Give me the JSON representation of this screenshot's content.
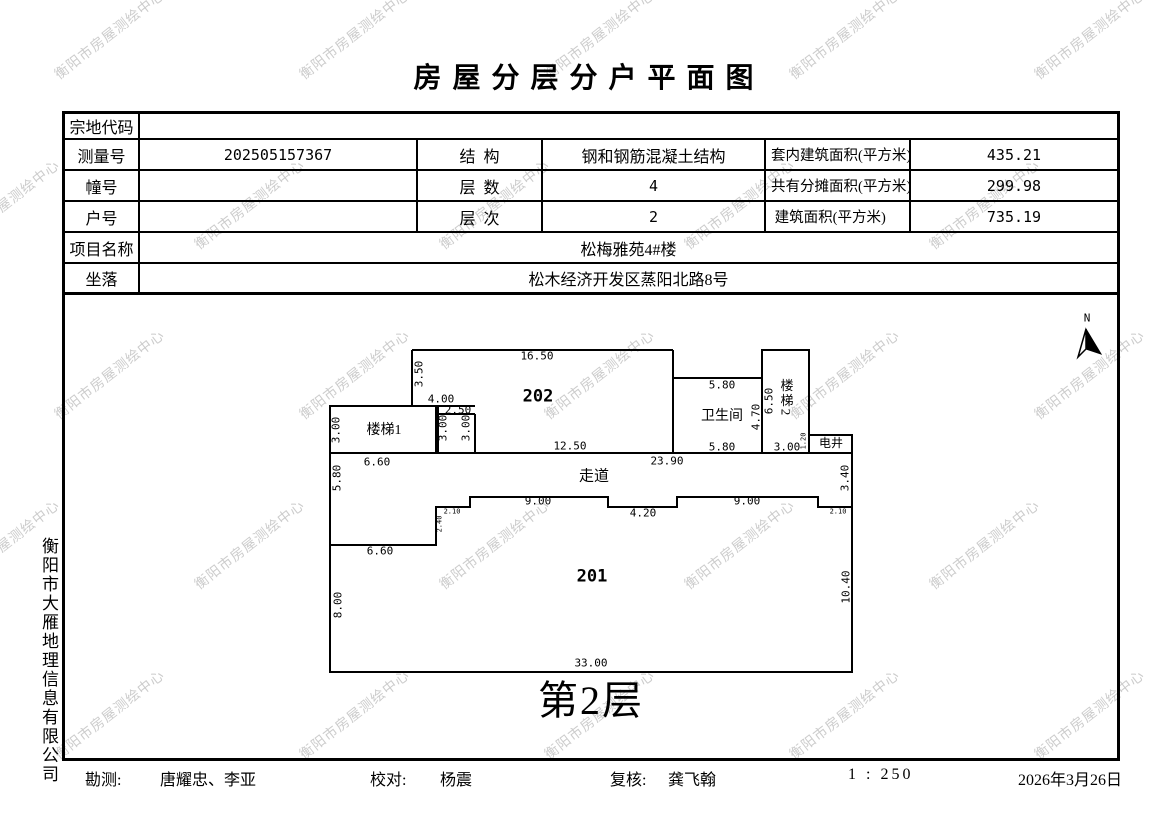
{
  "title": "房 屋 分 层 分 户 平 面 图",
  "watermark": {
    "text": "衡阳市房屋测绘中心",
    "color": "#c7c7c7"
  },
  "side_label": "衡阳市大雁地理信息有限公司",
  "table": {
    "parcel_label": "宗地代码",
    "parcel_value": "",
    "survey_label": "测量号",
    "survey_value": "202505157367",
    "structure_label": "结  构",
    "structure_value": "钢和钢筋混凝土结构",
    "inner_area_label": "套内建筑面积(平方米)",
    "inner_area_value": "435.21",
    "building_no_label": "幢号",
    "building_no_value": "",
    "floors_label": "层  数",
    "floors_value": "4",
    "shared_area_label": "共有分摊面积(平方米)",
    "shared_area_value": "299.98",
    "unit_no_label": "户号",
    "unit_no_value": "",
    "level_label": "层  次",
    "level_value": "2",
    "total_area_label": " 建筑面积(平方米)",
    "total_area_value": "735.19",
    "project_label": "项目名称",
    "project_value": "松梅雅苑4#楼",
    "location_label": "坐落",
    "location_value": "松木经济开发区蒸阳北路8号"
  },
  "plan": {
    "floor_caption": "第2层",
    "north_label": "N",
    "rooms": [
      {
        "t": "202",
        "x": 538,
        "y": 397,
        "cls": "room"
      },
      {
        "t": "201",
        "x": 592,
        "y": 577,
        "cls": "room"
      },
      {
        "t": "卫生间",
        "x": 722,
        "y": 417,
        "cls": "zh"
      },
      {
        "t": "走道",
        "x": 594,
        "y": 477,
        "cls": "zh-b"
      },
      {
        "t": "楼梯1",
        "x": 384,
        "y": 431,
        "cls": "zh"
      },
      {
        "t": "楼梯2",
        "x": 786,
        "y": 398,
        "cls": "zh-v"
      },
      {
        "t": "电井",
        "x": 831,
        "y": 443,
        "cls": "zh-s"
      }
    ],
    "dims": [
      {
        "t": "16.50",
        "x": 537,
        "y": 356
      },
      {
        "t": "3.50",
        "x": 419,
        "y": 374,
        "r": 1
      },
      {
        "t": "4.00",
        "x": 441,
        "y": 399
      },
      {
        "t": "2.50",
        "x": 458,
        "y": 410
      },
      {
        "t": "3.00",
        "x": 443,
        "y": 428,
        "r": 1
      },
      {
        "t": "3.00",
        "x": 466,
        "y": 428,
        "r": 1
      },
      {
        "t": "3.00",
        "x": 336,
        "y": 430,
        "r": 1
      },
      {
        "t": "6.60",
        "x": 377,
        "y": 462
      },
      {
        "t": "12.50",
        "x": 570,
        "y": 446
      },
      {
        "t": "5.80",
        "x": 722,
        "y": 385
      },
      {
        "t": "5.80",
        "x": 722,
        "y": 447
      },
      {
        "t": "6.50",
        "x": 769,
        "y": 401,
        "r": 1
      },
      {
        "t": "4.70",
        "x": 756,
        "y": 417,
        "r": 1
      },
      {
        "t": "3.00",
        "x": 787,
        "y": 447
      },
      {
        "t": "1.20",
        "x": 804,
        "y": 441,
        "r": 1,
        "s": 1
      },
      {
        "t": "23.90",
        "x": 667,
        "y": 461
      },
      {
        "t": "5.80",
        "x": 337,
        "y": 478,
        "r": 1
      },
      {
        "t": "3.40",
        "x": 845,
        "y": 478,
        "r": 1
      },
      {
        "t": "2.10",
        "x": 452,
        "y": 512,
        "s": 1
      },
      {
        "t": "2.40",
        "x": 440,
        "y": 524,
        "r": 1,
        "s": 1
      },
      {
        "t": "9.00",
        "x": 538,
        "y": 501
      },
      {
        "t": "4.20",
        "x": 643,
        "y": 513
      },
      {
        "t": "9.00",
        "x": 747,
        "y": 501
      },
      {
        "t": "2.10",
        "x": 838,
        "y": 512,
        "s": 1
      },
      {
        "t": "6.60",
        "x": 380,
        "y": 551
      },
      {
        "t": "8.00",
        "x": 338,
        "y": 605,
        "r": 1
      },
      {
        "t": "10.40",
        "x": 846,
        "y": 587,
        "r": 1
      },
      {
        "t": "33.00",
        "x": 591,
        "y": 663
      }
    ]
  },
  "footer": {
    "survey_label": "勘测:",
    "survey_value": "唐耀忠、李亚",
    "check_label": "校对:",
    "check_value": "杨震",
    "review_label": "复核:",
    "review_value": "龚飞翰",
    "scale": "1 : 250",
    "date": "2026年3月26日"
  }
}
